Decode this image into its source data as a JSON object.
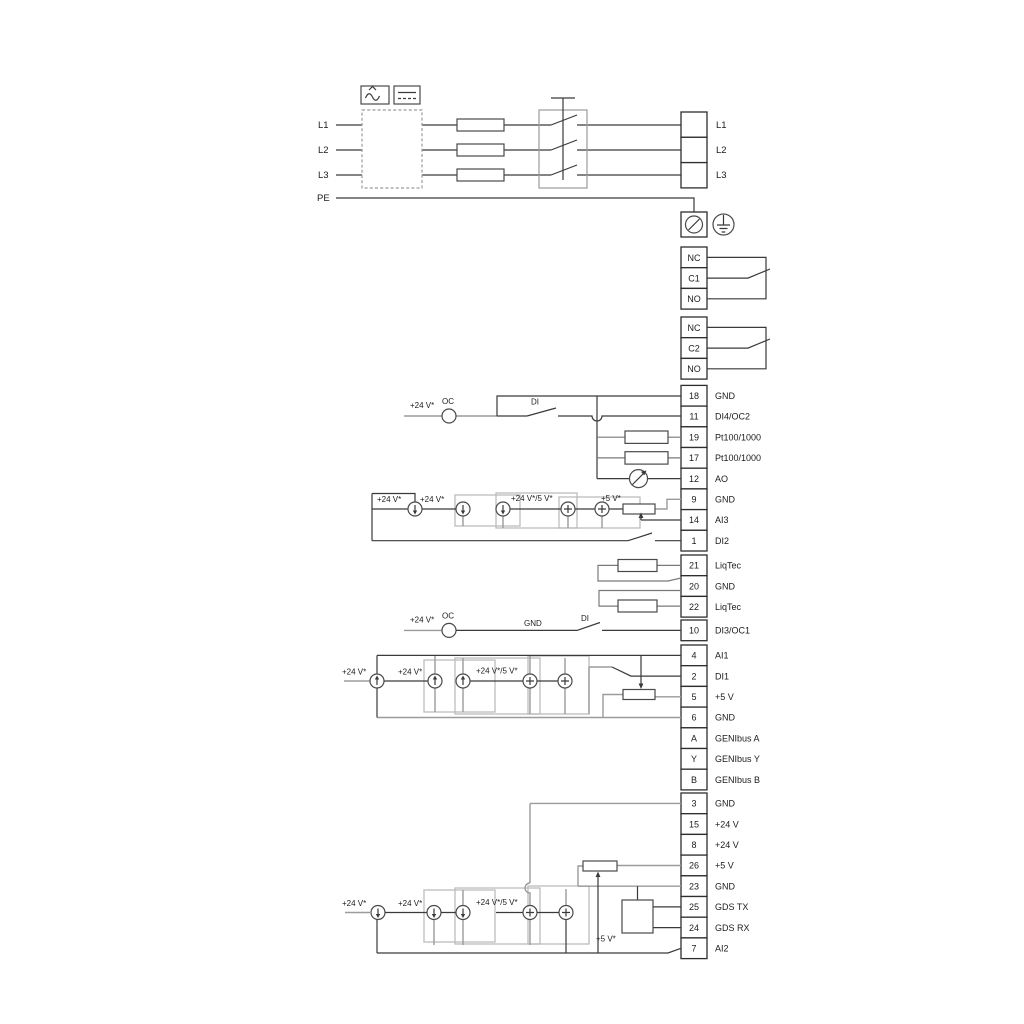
{
  "power": {
    "in": [
      {
        "label": "L1"
      },
      {
        "label": "L2"
      },
      {
        "label": "L3"
      },
      {
        "label": "PE"
      }
    ],
    "out": [
      {
        "label": "L1"
      },
      {
        "label": "L2"
      },
      {
        "label": "L3"
      }
    ]
  },
  "relay1": {
    "rows": [
      {
        "label": "NC"
      },
      {
        "label": "C1"
      },
      {
        "label": "NO"
      }
    ]
  },
  "relay2": {
    "rows": [
      {
        "label": "NC"
      },
      {
        "label": "C2"
      },
      {
        "label": "NO"
      }
    ]
  },
  "strip1": {
    "rows": [
      {
        "no": "18",
        "label": "GND"
      },
      {
        "no": "11",
        "label": "DI4/OC2"
      },
      {
        "no": "19",
        "label": "Pt100/1000"
      },
      {
        "no": "17",
        "label": "Pt100/1000"
      },
      {
        "no": "12",
        "label": "AO"
      },
      {
        "no": "9",
        "label": "GND"
      },
      {
        "no": "14",
        "label": "AI3"
      },
      {
        "no": "1",
        "label": "DI2"
      }
    ]
  },
  "strip2": {
    "rows": [
      {
        "no": "21",
        "label": "LiqTec"
      },
      {
        "no": "20",
        "label": "GND"
      },
      {
        "no": "22",
        "label": "LiqTec"
      }
    ]
  },
  "strip3": {
    "rows": [
      {
        "no": "10",
        "label": "DI3/OC1"
      },
      {
        "no": "4",
        "label": "AI1"
      },
      {
        "no": "2",
        "label": "DI1"
      },
      {
        "no": "5",
        "label": "+5 V"
      },
      {
        "no": "6",
        "label": "GND"
      },
      {
        "no": "A",
        "label": "GENIbus A"
      },
      {
        "no": "Y",
        "label": "GENIbus Y"
      },
      {
        "no": "B",
        "label": "GENIbus B"
      }
    ]
  },
  "strip4": {
    "rows": [
      {
        "no": "3",
        "label": "GND"
      },
      {
        "no": "15",
        "label": "+24 V"
      },
      {
        "no": "8",
        "label": "+24 V"
      },
      {
        "no": "26",
        "label": "+5 V"
      },
      {
        "no": "23",
        "label": "GND"
      },
      {
        "no": "25",
        "label": "GDS TX"
      },
      {
        "no": "24",
        "label": "GDS RX"
      },
      {
        "no": "7",
        "label": "AI2"
      }
    ]
  },
  "ann": {
    "v24": "+24 V*",
    "oc": "OC",
    "di": "DI",
    "gnd": "GND",
    "v24v5": "+24 V*/5 V*",
    "v5": "+5 V*"
  }
}
